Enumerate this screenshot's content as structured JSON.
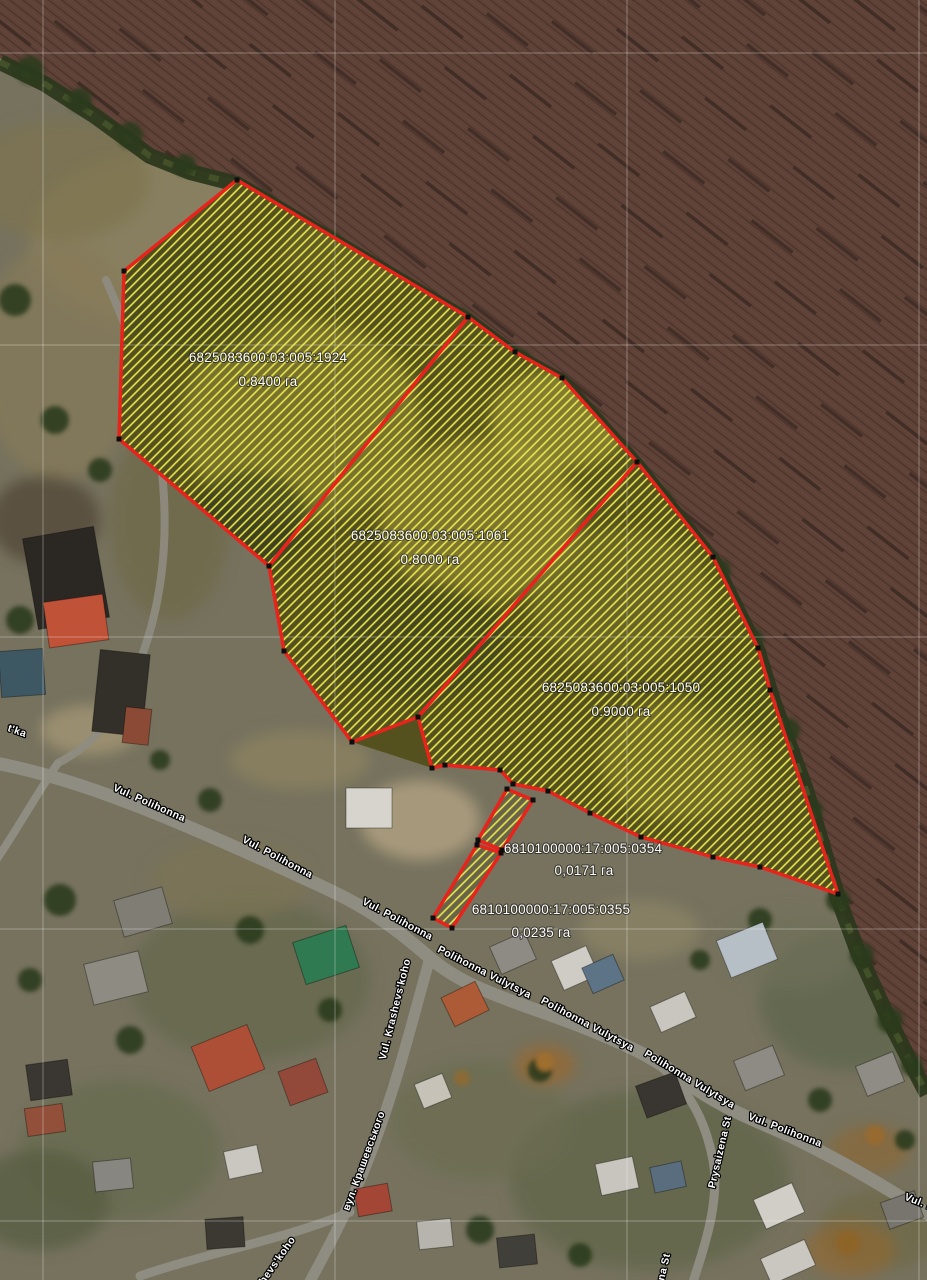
{
  "map": {
    "parcels": [
      {
        "id": "6825083600:03:005:1924",
        "area": "0.8400 га"
      },
      {
        "id": "6825083600:03:005:1061",
        "area": "0.8000 га"
      },
      {
        "id": "6825083600:03:005:1050",
        "area": "0.9000 га"
      },
      {
        "id": "6810100000:17:005:0354",
        "area": "0,0171 га"
      },
      {
        "id": "6810100000:17:005:0355",
        "area": "0,0235 га"
      }
    ],
    "streets": [
      {
        "name": "Vul. Polihonna"
      },
      {
        "name": "Vul. Polihonna"
      },
      {
        "name": "Vul. Polihonna"
      },
      {
        "name": "Polihonna Vulytsya"
      },
      {
        "name": "Polihonna Vulytsya"
      },
      {
        "name": "Polihonna Vulytsya"
      },
      {
        "name": "Vul. Polihonna"
      },
      {
        "name": "Vul. Krashevs'koho"
      },
      {
        "name": "вул. Крашевського"
      },
      {
        "name": "hevs'koho"
      },
      {
        "name": "Prysaizena St"
      },
      {
        "name": "Prysaizena St"
      },
      {
        "name": "t'ka"
      },
      {
        "name": "Vul. Polihonna"
      }
    ],
    "colors": {
      "parcel_outline": "#e8231c",
      "parcel_hatch": "#eae94e",
      "field_base": "#5e4137",
      "scrub_band": "#2c381c",
      "grid_line": "#ffffff"
    }
  }
}
